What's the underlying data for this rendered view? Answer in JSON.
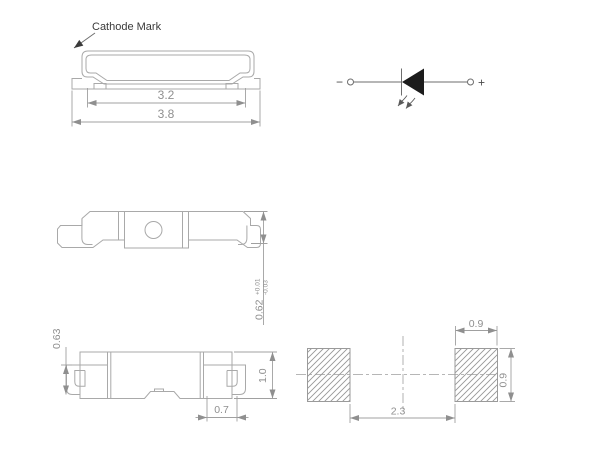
{
  "palette": {
    "outline_gray": "#a9a9a9",
    "dimension_gray": "#8f8f8f",
    "label_dark": "#3a3a3a",
    "symbol_fill": "#1c1c1c",
    "background": "#ffffff"
  },
  "views": {
    "top": {
      "cathode_label": "Cathode Mark",
      "dim_inner_width": "3.2",
      "dim_outer_width": "3.8"
    },
    "schematic": {
      "minus_label": "−",
      "plus_label": "+"
    },
    "bottom": {
      "dim_thickness": "0.62",
      "tol_plus": "+0.01",
      "tol_minus": "-0.03"
    },
    "front": {
      "dim_lead_height": "0.63",
      "dim_body_height": "1.0",
      "dim_lead_width": "0.7"
    },
    "pads": {
      "dim_pad_width": "0.9",
      "dim_pad_height": "0.9",
      "dim_gap": "2.3"
    }
  }
}
